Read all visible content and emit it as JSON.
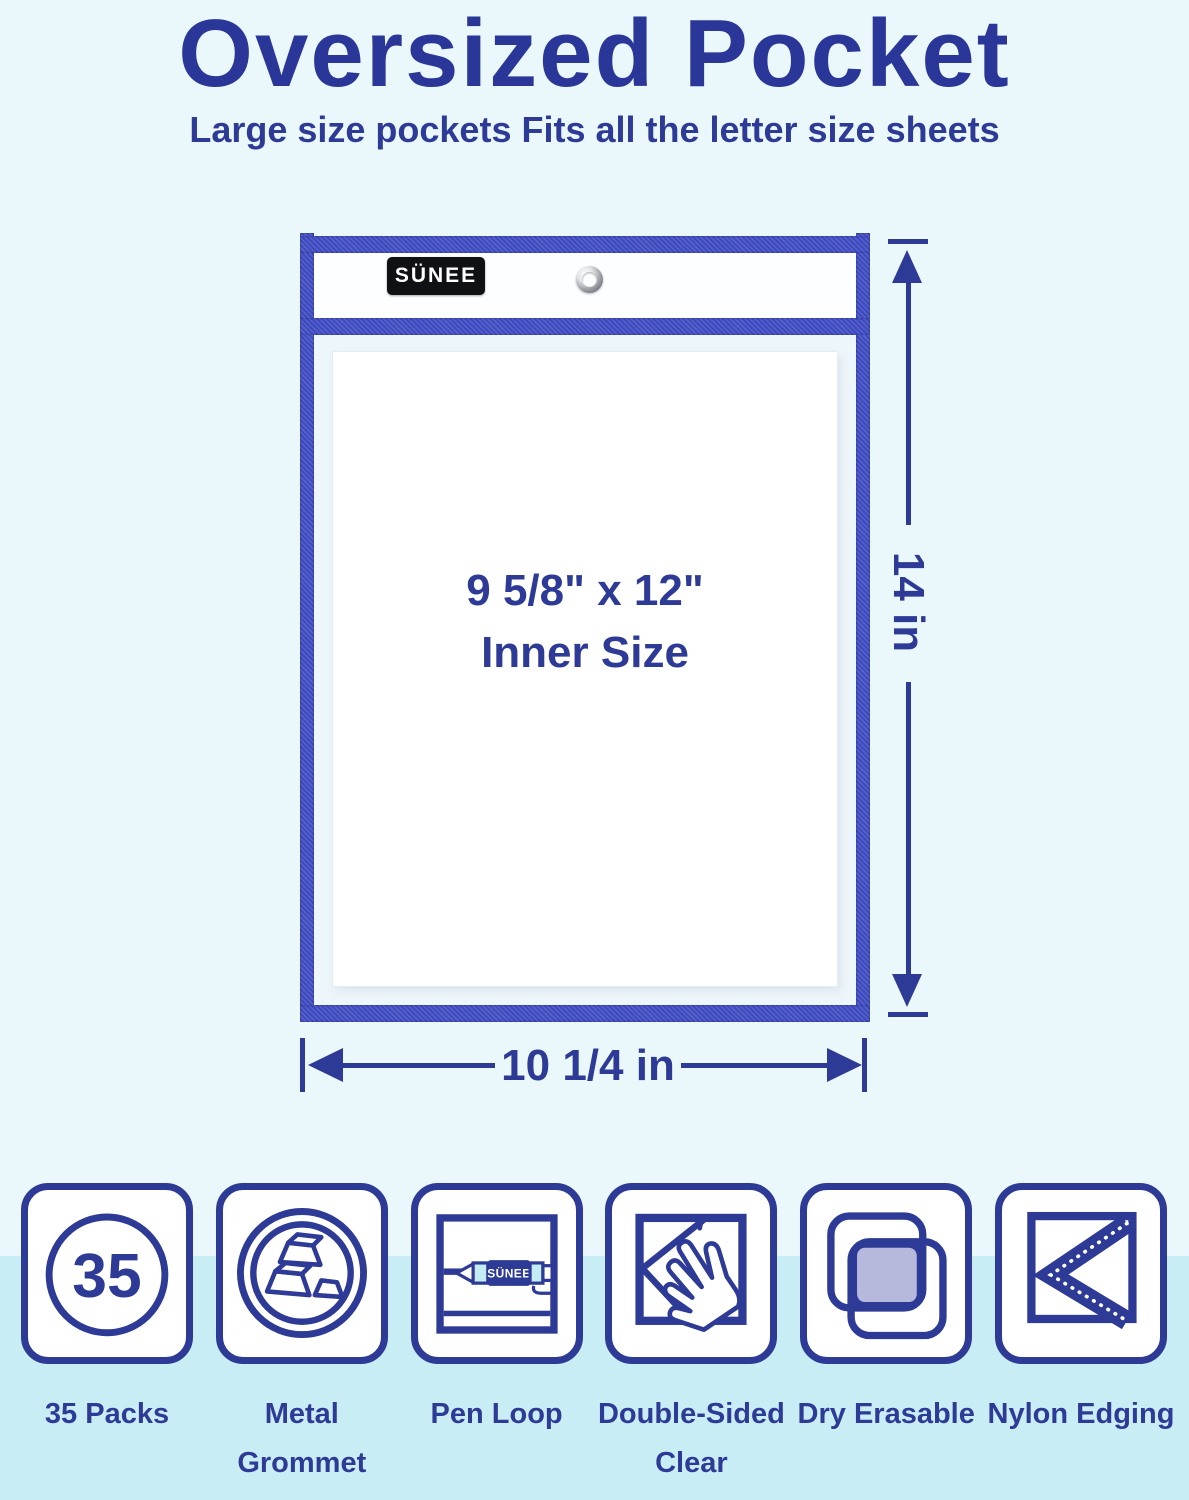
{
  "colors": {
    "ink": "#2d3a96",
    "title_ink": "#2b3699",
    "edging": "#3e4ac0",
    "bg": "#eaf8fc",
    "band": "#c9edf4",
    "lavender": "#b6b8dc",
    "pen_cyan": "#c3ecf5",
    "grommet_gray": "#8d8f95",
    "tag_bg": "#101114",
    "sheet": "#ffffff",
    "pocket_body": "#edf6fa",
    "pocket_header": "#fcfeff"
  },
  "header": {
    "title": "Oversized Pocket",
    "subtitle": "Large size pockets Fits all the letter size sheets"
  },
  "pocket": {
    "brand": "SÜNEE",
    "inner_size_line1": "9 5/8\" x 12\"",
    "inner_size_line2": "Inner Size",
    "height_label": "14 in",
    "width_label": "10 1/4 in"
  },
  "features": [
    {
      "label": "35 Packs",
      "count": "35",
      "icon": "count-circle-icon"
    },
    {
      "label": "Metal\nGrommet",
      "icon": "metal-ingots-icon"
    },
    {
      "label": "Pen Loop",
      "icon": "pen-loop-icon",
      "pen_brand": "SÜNEE"
    },
    {
      "label": "Double-Sided\nClear",
      "icon": "hand-on-sheet-icon"
    },
    {
      "label": "Dry Erasable",
      "icon": "overlapping-squares-icon"
    },
    {
      "label": "Nylon Edging",
      "icon": "corner-edging-icon"
    }
  ]
}
